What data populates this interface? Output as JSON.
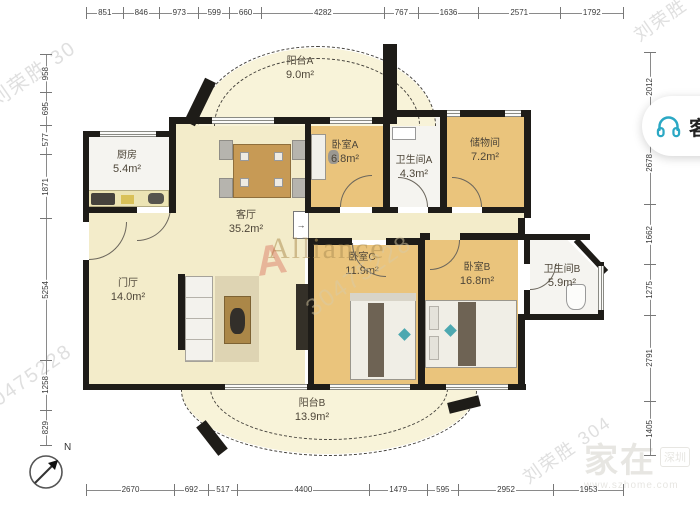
{
  "floorplan": {
    "rooms": [
      {
        "name": "阳台A",
        "area": "9.0m²"
      },
      {
        "name": "厨房",
        "area": "5.4m²"
      },
      {
        "name": "卧室A",
        "area": "6.8m²"
      },
      {
        "name": "卫生间A",
        "area": "4.3m²"
      },
      {
        "name": "储物间",
        "area": "7.2m²"
      },
      {
        "name": "客厅",
        "area": "35.2m²"
      },
      {
        "name": "门厅",
        "area": "14.0m²"
      },
      {
        "name": "卧室C",
        "area": "11.9m²"
      },
      {
        "name": "卧室B",
        "area": "16.8m²"
      },
      {
        "name": "卫生间B",
        "area": "5.9m²"
      },
      {
        "name": "阳台B",
        "area": "13.9m²"
      }
    ],
    "dimensions": {
      "top": [
        "851",
        "846",
        "973",
        "599",
        "660",
        "4282",
        "767",
        "1636",
        "2571",
        "1792"
      ],
      "bottom": [
        "2670",
        "692",
        "517",
        "4400",
        "1479",
        "595",
        "2952",
        "1953"
      ],
      "left": [
        "958",
        "695",
        "577",
        "1871",
        "5254",
        "1258",
        "829"
      ],
      "right": [
        "2012",
        "2678",
        "1662",
        "1275",
        "2791",
        "1405"
      ]
    },
    "compass_label": "N"
  },
  "watermarks": {
    "items": [
      {
        "text": "刘荣胜 30"
      },
      {
        "text": "刘荣胜"
      },
      {
        "text": "30475228"
      },
      {
        "text": "30475228"
      },
      {
        "text": "刘荣胜 304"
      }
    ],
    "brand": "Alliance",
    "brand_logo": "A",
    "site_logo": {
      "main": "家在",
      "badge": "深圳",
      "url": "www.szhome.com"
    }
  },
  "service_button": {
    "label": "客",
    "icon": "headset-icon",
    "icon_color": "#2ba8c4"
  },
  "colors": {
    "wall": "#1e1c18",
    "bedroom_floor": "#eac47c",
    "living_floor": "#f3ecca",
    "balcony_floor": "#f8f3d9",
    "wet_floor": "#f5f4f0",
    "accent_teal": "#2ba8c4"
  }
}
